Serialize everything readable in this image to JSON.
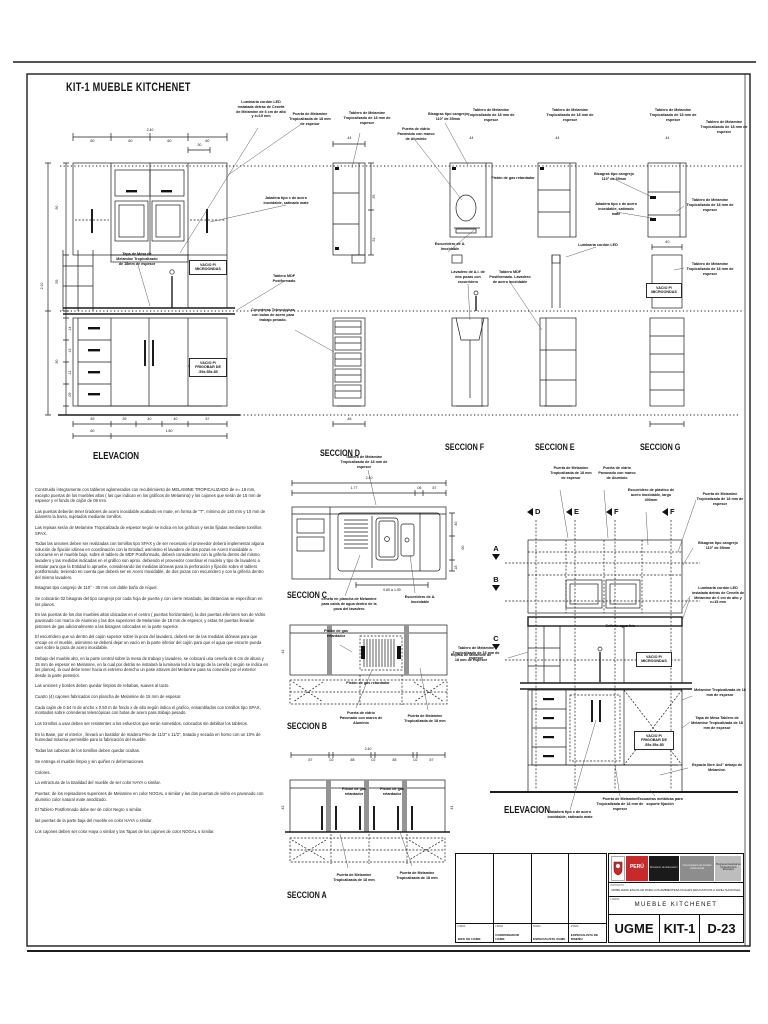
{
  "sheet": {
    "title": "KIT-1 MUEBLE KITCHENET"
  },
  "section_labels": [
    {
      "t": "ELEVACION",
      "x": 93,
      "y": 451,
      "fs": 10
    },
    {
      "t": "SECCION D",
      "x": 320,
      "y": 448
    },
    {
      "t": "SECCION F",
      "x": 445,
      "y": 442
    },
    {
      "t": "SECCION E",
      "x": 535,
      "y": 442
    },
    {
      "t": "SECCION G",
      "x": 640,
      "y": 442
    },
    {
      "t": "SECCION C",
      "x": 287,
      "y": 590
    },
    {
      "t": "SECCION B",
      "x": 287,
      "y": 721
    },
    {
      "t": "SECCION A",
      "x": 287,
      "y": 890
    },
    {
      "t": "ELEVACION",
      "x": 504,
      "y": 805,
      "fs": 10
    }
  ],
  "cut_markers_top": [
    {
      "letter": "D",
      "x": 527
    },
    {
      "letter": "E",
      "x": 566
    },
    {
      "letter": "F",
      "x": 606
    },
    {
      "letter": "F",
      "x": 662
    }
  ],
  "cut_markers_left": [
    {
      "letter": "A",
      "y": 544
    },
    {
      "letter": "B",
      "y": 575
    },
    {
      "letter": "C",
      "y": 634
    }
  ],
  "annotations": [
    {
      "t": "Luminaria cordón LED instalada detrás de Cenefa de Melamine de 6 cm de alto y e=15 mm",
      "x": 236,
      "y": 100,
      "w": 50
    },
    {
      "t": "Puerta de Melamine Tropicalizada de 18 mm de espesor",
      "x": 288,
      "y": 112,
      "w": 44
    },
    {
      "t": "Tablero de Melamine Tropicalizado de 18 mm de espesor",
      "x": 343,
      "y": 111,
      "w": 48
    },
    {
      "t": "Bisagras tipo cangrejo 110° de 35mm",
      "x": 426,
      "y": 112,
      "w": 44
    },
    {
      "t": "Puerta de vidrio Pavonado con marco de Aluminio",
      "x": 396,
      "y": 127,
      "w": 40
    },
    {
      "t": "Tablero de Melamine Tropicalizado de 18 mm de espesor",
      "x": 466,
      "y": 108,
      "w": 50
    },
    {
      "t": "Tablero de Melamine Tropicalizado de 18 mm de espesor",
      "x": 545,
      "y": 108,
      "w": 50
    },
    {
      "t": "Tablero de Melamine Tropicalizado de 18 mm de espesor",
      "x": 648,
      "y": 108,
      "w": 50
    },
    {
      "t": "Tablero de Melamine Tropicalizado de 18 mm de espesor",
      "x": 700,
      "y": 120,
      "w": 48
    },
    {
      "t": "Jaladera tipo c de acero inoxidable, satinado mate",
      "x": 262,
      "y": 196,
      "w": 48
    },
    {
      "t": "Bisagras tipo cangrejo 110° de 35mm",
      "x": 592,
      "y": 172,
      "w": 44
    },
    {
      "t": "Jaladera tipo c de acero inoxidable, satinado mate",
      "x": 594,
      "y": 202,
      "w": 44
    },
    {
      "t": "Tablero de Melamine Tropicalizado de 18 mm de espesor",
      "x": 684,
      "y": 198,
      "w": 52
    },
    {
      "t": "Pistón de gas retardador",
      "x": 490,
      "y": 176,
      "w": 46
    },
    {
      "t": "Luminaria cordón LED",
      "x": 576,
      "y": 243,
      "w": 44
    },
    {
      "t": "Tablero de Melamine Tropicalizado de 18 mm de espesor",
      "x": 684,
      "y": 262,
      "w": 52
    },
    {
      "t": "Tablero MDF Postformado",
      "x": 264,
      "y": 274,
      "w": 40
    },
    {
      "t": "Tablero MDF Postformado. Lavadero de acero Inoxidable",
      "x": 488,
      "y": 270,
      "w": 44
    },
    {
      "t": "Correderas Telescópicas con bolas de acero para trabajo pesado.",
      "x": 248,
      "y": 308,
      "w": 50
    },
    {
      "t": "Tapa de Mesa de Melamine Tropicalizado de 18mm de espesor",
      "x": 116,
      "y": 252,
      "w": 42
    },
    {
      "t": "Escurridero de A. Inoxidable",
      "x": 428,
      "y": 242,
      "w": 44
    },
    {
      "t": "Lavadero de A.I. de dos pozas con escurridero",
      "x": 448,
      "y": 270,
      "w": 40
    },
    {
      "t": "VACIO P/ MICROONDAS",
      "x": 189,
      "y": 260,
      "w": 34,
      "b": true
    },
    {
      "t": "VACIO P/ FRIGOBAR DE .55x.55x.85",
      "x": 189,
      "y": 358,
      "w": 34,
      "b": true
    },
    {
      "t": "VACIO P/ MICROONDAS",
      "x": 646,
      "y": 283,
      "w": 32,
      "b": true
    },
    {
      "t": "Tablero de Melamine Tropicalizado de 18 mm de espesor",
      "x": 338,
      "y": 455,
      "w": 52
    },
    {
      "t": "cenefa en plancha de Melamine para caída de agua dentro de la poza del lavadero",
      "x": 318,
      "y": 597,
      "w": 62
    },
    {
      "t": "Escurridero de A. Inoxidable",
      "x": 398,
      "y": 595,
      "w": 44
    },
    {
      "t": "Pistón de gas retardador",
      "x": 316,
      "y": 629,
      "w": 40
    },
    {
      "t": "Pistón de gas retardador",
      "x": 334,
      "y": 681,
      "w": 68
    },
    {
      "t": "Puerta de vidrio Pavonado con marco de Aluminio",
      "x": 338,
      "y": 711,
      "w": 46
    },
    {
      "t": "Puerta de Melamine Tropicalizada de 18 mm",
      "x": 400,
      "y": 714,
      "w": 50
    },
    {
      "t": "Tablero de Melamine Tropicalizado de 18 mm de espesor",
      "x": 452,
      "y": 646,
      "w": 48
    },
    {
      "t": "Pistón de gas retardador",
      "x": 334,
      "y": 787,
      "w": 40
    },
    {
      "t": "Pistón de gas retardador",
      "x": 372,
      "y": 787,
      "w": 40
    },
    {
      "t": "Puerta de Melamine Tropicalizada de 18 mm",
      "x": 330,
      "y": 873,
      "w": 48
    },
    {
      "t": "Puerta de Melamine Tropicalizada de 18 mm",
      "x": 392,
      "y": 871,
      "w": 50
    },
    {
      "t": "Puerta de Melamine Tropicalizada de 18 mm de espesor",
      "x": 548,
      "y": 466,
      "w": 46
    },
    {
      "t": "Puerta de vidrio Pavonado con marco de Aluminio",
      "x": 596,
      "y": 466,
      "w": 42
    },
    {
      "t": "Escurridero de plástico de acero inoxidable, largo 400mm",
      "x": 626,
      "y": 488,
      "w": 50
    },
    {
      "t": "Puerta de Melamine Tropicalizada de 18 mm de espesor",
      "x": 694,
      "y": 492,
      "w": 52
    },
    {
      "t": "Bisagras tipo cangrejo 110° de 35mm",
      "x": 694,
      "y": 541,
      "w": 48
    },
    {
      "t": "Luminaria cordón LED instalada detrás de Cenefa de Melamine de 6 cm de alto y e=15 mm",
      "x": 690,
      "y": 586,
      "w": 56
    },
    {
      "t": "Grifería agua fría",
      "x": 598,
      "y": 624,
      "w": 44
    },
    {
      "t": "Repisa de Melamine de 18 mm de espesor",
      "x": 450,
      "y": 653,
      "w": 42
    },
    {
      "t": "Melamine Tropicalizada de 18 mm de espesor",
      "x": 694,
      "y": 688,
      "w": 52
    },
    {
      "t": "Tapa de Mesa Tablero de Melamine Tropicalizada de 18 mm de espesor",
      "x": 690,
      "y": 716,
      "w": 54
    },
    {
      "t": "Espacio libre 4x4\" debajo de Melamine.",
      "x": 690,
      "y": 763,
      "w": 54
    },
    {
      "t": "VACIO P/ MICROONDAS",
      "x": 636,
      "y": 652,
      "w": 32,
      "b": true
    },
    {
      "t": "VACIO P/ FRIGOBAR DE .55x.55x.85",
      "x": 634,
      "y": 731,
      "w": 36,
      "b": true
    },
    {
      "t": "Jaladera tipo c de acero inoxidable, satinado mate",
      "x": 546,
      "y": 810,
      "w": 48
    },
    {
      "t": "Puerta de Melamine Tropicalizada de 18 mm de espesor",
      "x": 596,
      "y": 797,
      "w": 48
    },
    {
      "t": "Escuadras metálicas para soporte fijación",
      "x": 636,
      "y": 797,
      "w": 48
    }
  ],
  "dimensions": [
    {
      "t": "2.40",
      "x": 150,
      "y": 128
    },
    {
      "t": ".60",
      "x": 92,
      "y": 139
    },
    {
      "t": ".60",
      "x": 130,
      "y": 139
    },
    {
      "t": ".60",
      "x": 169,
      "y": 139
    },
    {
      "t": ".60",
      "x": 207,
      "y": 139
    },
    {
      "t": ".30",
      "x": 199,
      "y": 143
    },
    {
      "t": ".59",
      "x": 92,
      "y": 417
    },
    {
      "t": ".39",
      "x": 124,
      "y": 417
    },
    {
      "t": ".40",
      "x": 149,
      "y": 417
    },
    {
      "t": ".40",
      "x": 175,
      "y": 417
    },
    {
      "t": ".57",
      "x": 207,
      "y": 417
    },
    {
      "t": ".60",
      "x": 92,
      "y": 429
    },
    {
      "t": "1.80",
      "x": 169,
      "y": 429
    },
    {
      "t": "2.10",
      "x": 42,
      "y": 284,
      "r": true
    },
    {
      "t": ".90",
      "x": 57,
      "y": 206,
      "r": true
    },
    {
      "t": ".55",
      "x": 57,
      "y": 280,
      "r": true
    },
    {
      "t": ".90",
      "x": 57,
      "y": 360,
      "r": true
    },
    {
      "t": ".14",
      "x": 70,
      "y": 327,
      "r": true
    },
    {
      "t": ".12",
      "x": 70,
      "y": 349,
      "r": true
    },
    {
      "t": ".12",
      "x": 70,
      "y": 371,
      "r": true
    },
    {
      "t": ".09",
      "x": 70,
      "y": 393,
      "r": true
    },
    {
      "t": ".44",
      "x": 349,
      "y": 136
    },
    {
      "t": ".44",
      "x": 471,
      "y": 136
    },
    {
      "t": ".44",
      "x": 557,
      "y": 136
    },
    {
      "t": ".44",
      "x": 667,
      "y": 136
    },
    {
      "t": ".35",
      "x": 374,
      "y": 195,
      "r": true
    },
    {
      "t": ".31",
      "x": 374,
      "y": 238,
      "r": true
    },
    {
      "t": ".46",
      "x": 349,
      "y": 417
    },
    {
      "t": ".40",
      "x": 667,
      "y": 240
    },
    {
      "t": "2.40",
      "x": 369,
      "y": 476
    },
    {
      "t": "1.77",
      "x": 354,
      "y": 486
    },
    {
      "t": ".06",
      "x": 419,
      "y": 486
    },
    {
      "t": ".57",
      "x": 434,
      "y": 486
    },
    {
      "t": "0.80 a 1.00",
      "x": 392,
      "y": 588
    },
    {
      "t": ".40",
      "x": 456,
      "y": 522,
      "r": true
    },
    {
      "t": ".60",
      "x": 463,
      "y": 546,
      "r": true
    },
    {
      "t": ".18",
      "x": 456,
      "y": 566,
      "r": true
    },
    {
      "t": "2.40",
      "x": 368,
      "y": 747
    },
    {
      "t": ".57",
      "x": 310,
      "y": 758
    },
    {
      "t": ".02",
      "x": 331,
      "y": 758
    },
    {
      "t": ".58",
      "x": 352,
      "y": 758
    },
    {
      "t": ".02",
      "x": 373,
      "y": 758
    },
    {
      "t": ".58",
      "x": 394,
      "y": 758
    },
    {
      "t": ".02",
      "x": 415,
      "y": 758
    },
    {
      "t": ".57",
      "x": 431,
      "y": 758
    },
    {
      "t": ".42",
      "x": 283,
      "y": 806,
      "r": true
    },
    {
      "t": ".44",
      "x": 452,
      "y": 806,
      "r": true
    },
    {
      "t": ".42",
      "x": 283,
      "y": 650,
      "r": true
    }
  ],
  "notes": [
    "Construido íntegramente con tableros aglomerados con recubrimiento de MELAMINE TROPICALIZADO de e= 18 mm, excepto puertas de los muebles altos ( las que indican en los gráficos de Melamina) y los cajones que serán de 15 mm de espesor y el fondo de cajón de 09 mm.",
    "Las puertas deberán tener tiradores de acero inoxidable acabado en mate, en forma de \"T\", mínimo de 140 mm y 10 mm de diámetro la barra, sujetados mediante tornillos.",
    "Las repisas serán de Melamine Tropicalizado de espesor según se indica en los gráficos y serán fijadas mediante tornillos SPAX.",
    "Todas las uniones deben ser realizadas con tornillos tipo SPAX y de ser necesario el proveedor deberá implementar alguna solución de fijación idónea en coordinación con la Entidad; asimismo el lavadero de dos pozas en Acero Inoxidable a colocarse en el mueble bajo, sobre el tablero de MDF Postformado, deberá considerarse con la grifería dentro del mismo lavadero y las medidas indicadas en el gráfico son aprox. debiendo el proveedor coordinar el modelo y tipo de lavadero a instalar para que la Entidad lo apruebe, considerando las medidas idóneas para la perforación y fijación sobre el tablero postformado, teniendo en cuenta que deberá ser en Acero Inoxidable, de dos pozas con escurridero y con la grifería dentro del mismo lavadero.",
    "Bisagras tipo cangrejo de 110° - 35 mm con doble baño de níquel.",
    "Se colocarán 02 bisagras del tipo cangrejo por cada hoja de puerta y con cierre retardado, las distancias se especifican en los planos.",
    "En las puertas de los dos muebles altos ubicadas en el centro ( puertas horizontales), la dos puertas inferiores son de Vidrio pavonado con marco de Aluminio y las dos superiores de Melamine de 18 mm de espesor, y estas 04 puertas llevarán pistones de gas adicionalmente a las bisagras colocadas en la parte superior.",
    "El escurridero que va dentro del cajón superior sobre la poza del lavadero, deberá ser de las medidas idóneas para que encaje en el mueble, asimismo se deberá dejar un vacío en la parte inferior del cajón para que el agua que escurre pueda caer sobre la poza de acero inoxidable.",
    "Debajo del mueble alto, en la parte central sobre la mesa de trabajo y lavadero, se colocará una cenefa de 6 cm de altura y 15 mm de espesor en Melamine, en la cual por detrás se instalará la luminaria led a lo largo de la cenefa ( según se indica en los planos), la cual debe tener hacia el extremo derecho un pase atraves del Melamine para su conexión por el exterior desde la parte posterior.",
    "Las uniones y bordes deben quedar limpios de rebabas, suaves al tacto.",
    "Cuatro (4) cajones fabricados con plancha de Melamine de 15 mm de espesor.",
    "Cada cajón de 0.54 m de ancho x 0.50 m de fondo x de alto según indica el grafico, ensamblados con tornillos tipo SPAX, montados sobre correderas telescópicas con bolas de acero para trabajo pesado.",
    "Los tornillos a usar deben ser resistentes a los esfuerzos que serán sometidos, colocados sin debilitar los tableros.",
    "En la Base, por el interior , llevará un bastidor de madera Pino de 11/2\" x 11/2\", tratada y secada en horno con un 10% de humedad máxima permisible para la fabricación del mueble.",
    "Todas las cabezas de los tornillos deben quedar ocultas.",
    "Se entrega el mueble limpio y sin quiñes ni deformaciones.",
    "Colores.",
    "La estructura de la totalidad del mueble de ser color HAYA o similar.",
    "Puertas: de los repisadores superiores de Melamine en color NOGAL o similar y las dos puertas de vidrio en pavonado con aluminio color natural mate anodizado.",
    "El Tablero Postformado debe ser de color Negro o similar.",
    "las puertas de la parte baja del mueble en color HAYA o similar.",
    "Los cajones deben ser color Haya o similar y las Tapas de los cajones de color NOGAL o similar."
  ],
  "titleblock": {
    "firma_label": "FIRMA",
    "signatures": [
      "JEFE DE UGME",
      "COORDINADOR UGME",
      "ESPECIALISTA UGME",
      "ESPECIALISTA DE DISEÑO"
    ],
    "brand_red": "PERÚ",
    "brand_black": "Ministerio de Educación",
    "brand_gray": "Viceministerio de Gestión Institucional",
    "brand_light": "Programa Nacional de Infraestructura Educativa",
    "project_label": "PROYECTO",
    "project": "MOBILIARIO ESCOLAR PARA LOS AMBIENTES/LOCALES EDUCATIVOS A NIVEL NACIONAL",
    "sheet_label": "LAMINA",
    "sheet_title": "MUEBLE  KITCHENET",
    "dept": "UGME",
    "kit": "KIT-1",
    "code": "D-23",
    "colors": {
      "red": "#c8292b",
      "black": "#1a1a1a",
      "gray": "#8d8d8d",
      "lightgray": "#bdbdbd"
    }
  }
}
